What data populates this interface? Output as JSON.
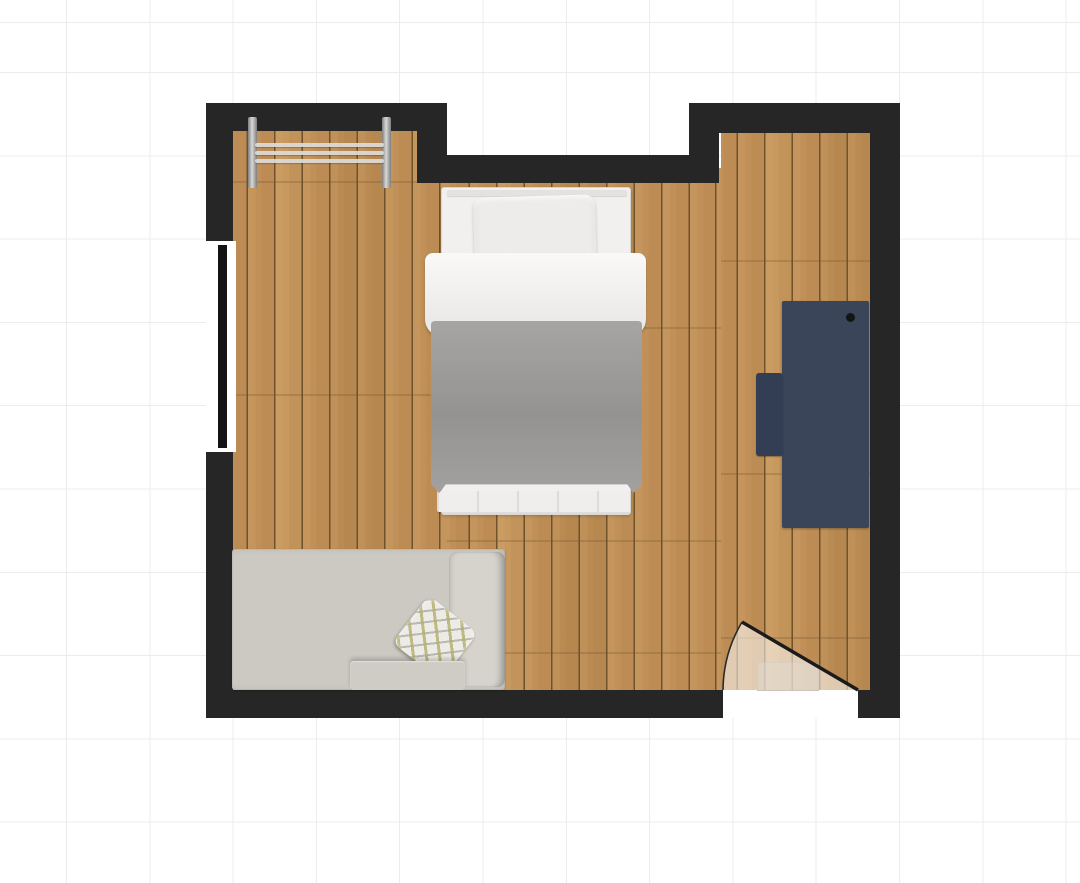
{
  "app": {
    "name": "room-planner-canvas",
    "view": "2d-floor-plan-top-view"
  },
  "canvas": {
    "background_color": "#ffffff",
    "grid_line_color": "#ececec",
    "grid_cell_px": 83.3,
    "grid_offset_x_px": 66,
    "grid_offset_y_px": 23
  },
  "room": {
    "wall_color": "#262626",
    "floor": {
      "material": "wood-planks",
      "plank_direction": "vertical",
      "plank_width_px": 27.5,
      "base_color": "#c09058",
      "light_color": "#d4a96d",
      "dark_color": "#a87c45",
      "seam_color": "#6e522c"
    },
    "window": {
      "wall": "left",
      "frame_color": "#ffffff",
      "glass_color": "#131313"
    },
    "door": {
      "wall": "bottom",
      "state": "open",
      "opening_color": "#ffffff",
      "swing_fill": "rgba(255,255,255,0.55)",
      "swing_edge_color": "#2b2b2b",
      "leaf_color": "#1b1b1b"
    }
  },
  "furniture": {
    "clothes_rack": {
      "label": "wall clothes rack",
      "post_color": "#a8a8a6",
      "rail_color": "#dddbd8",
      "rail_count": 3
    },
    "bed": {
      "label": "single bed",
      "frame_color": "#f1f0ee",
      "headboard_color": "#e4e2de",
      "pillow_color": "#edecea",
      "sheet_color": "#f4f3f1",
      "duvet_color": "#9d9c9a",
      "foot_color": "#efeeec"
    },
    "desk": {
      "label": "desk",
      "top_color": "#3b4559",
      "knob_color": "#141414"
    },
    "desk_chair": {
      "label": "desk chair",
      "color": "#333e55"
    },
    "sofa": {
      "label": "sofa daybed",
      "body_color": "#ccc9c2",
      "armrest_color": "#d6d3cc",
      "cushion_color": "#cfccc5",
      "pillow_base_color": "#edebe5",
      "pillow_accent_color": "#b2ad68",
      "pillow_shadow_color": "#96958f"
    }
  }
}
